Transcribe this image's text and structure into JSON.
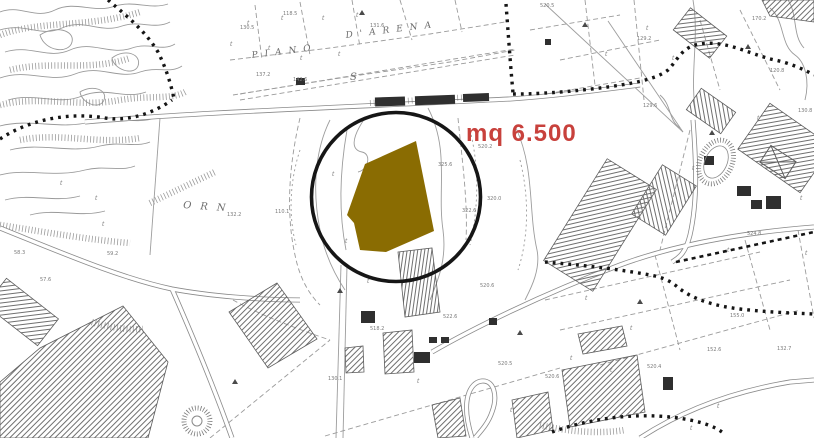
{
  "annotation": {
    "area_text": "mq 6.500",
    "text_color": "#c8413c",
    "parcel_fill": "#8a6c02",
    "parcel_edge": "#a38300",
    "circle_color": "#161616"
  },
  "map_texts": {
    "piano": "PIANO",
    "darena": "D'ARENA",
    "orn": "ORN",
    "s": "S"
  },
  "labels": [
    {
      "t": "118.5",
      "x": 283,
      "y": 15
    },
    {
      "t": "130.5",
      "x": 240,
      "y": 29
    },
    {
      "t": "131.6",
      "x": 370,
      "y": 27
    },
    {
      "t": "137.2",
      "x": 256,
      "y": 76
    },
    {
      "t": "142.6",
      "x": 293,
      "y": 81
    },
    {
      "t": "520.5",
      "x": 540,
      "y": 7
    },
    {
      "t": "170.2",
      "x": 752,
      "y": 20
    },
    {
      "t": "129.2",
      "x": 637,
      "y": 40
    },
    {
      "t": "120.8",
      "x": 770,
      "y": 72
    },
    {
      "t": "130.8",
      "x": 798,
      "y": 112
    },
    {
      "t": "129.6",
      "x": 643,
      "y": 107
    },
    {
      "t": "325.6",
      "x": 438,
      "y": 166
    },
    {
      "t": "320.0",
      "x": 487,
      "y": 200
    },
    {
      "t": "322.6",
      "x": 462,
      "y": 212
    },
    {
      "t": "520.2",
      "x": 478,
      "y": 148
    },
    {
      "t": "132.2",
      "x": 227,
      "y": 216
    },
    {
      "t": "110.1",
      "x": 275,
      "y": 213
    },
    {
      "t": "59.2",
      "x": 107,
      "y": 255
    },
    {
      "t": "58.3",
      "x": 14,
      "y": 254
    },
    {
      "t": "57.6",
      "x": 40,
      "y": 281
    },
    {
      "t": "520.6",
      "x": 480,
      "y": 287
    },
    {
      "t": "522.6",
      "x": 443,
      "y": 318
    },
    {
      "t": "518.2",
      "x": 370,
      "y": 330
    },
    {
      "t": "130.1",
      "x": 328,
      "y": 380
    },
    {
      "t": "520.5",
      "x": 498,
      "y": 365
    },
    {
      "t": "520.6",
      "x": 545,
      "y": 378
    },
    {
      "t": "520.4",
      "x": 647,
      "y": 368
    },
    {
      "t": "155.0",
      "x": 730,
      "y": 317
    },
    {
      "t": "152.6",
      "x": 707,
      "y": 351
    },
    {
      "t": "132.7",
      "x": 777,
      "y": 350
    },
    {
      "t": "524.8",
      "x": 747,
      "y": 235
    }
  ],
  "symbols": {
    "vegetation": [
      [
        247,
        25
      ],
      [
        281,
        20
      ],
      [
        322,
        20
      ],
      [
        356,
        17
      ],
      [
        268,
        50
      ],
      [
        230,
        46
      ],
      [
        300,
        60
      ],
      [
        338,
        56
      ],
      [
        332,
        176
      ],
      [
        345,
        243
      ],
      [
        367,
        283
      ],
      [
        95,
        200
      ],
      [
        102,
        226
      ],
      [
        60,
        185
      ],
      [
        646,
        30
      ],
      [
        605,
        56
      ],
      [
        692,
        170
      ],
      [
        727,
        252
      ],
      [
        570,
        360
      ],
      [
        610,
        372
      ],
      [
        417,
        383
      ],
      [
        510,
        412
      ],
      [
        585,
        300
      ],
      [
        630,
        330
      ],
      [
        757,
        120
      ],
      [
        800,
        200
      ],
      [
        805,
        255
      ],
      [
        690,
        430
      ],
      [
        717,
        408
      ],
      [
        672,
        60
      ]
    ],
    "triangles": [
      [
        362,
        13
      ],
      [
        585,
        25
      ],
      [
        748,
        47
      ],
      [
        235,
        382
      ],
      [
        340,
        291
      ],
      [
        520,
        333
      ],
      [
        640,
        302
      ],
      [
        712,
        133
      ]
    ]
  }
}
